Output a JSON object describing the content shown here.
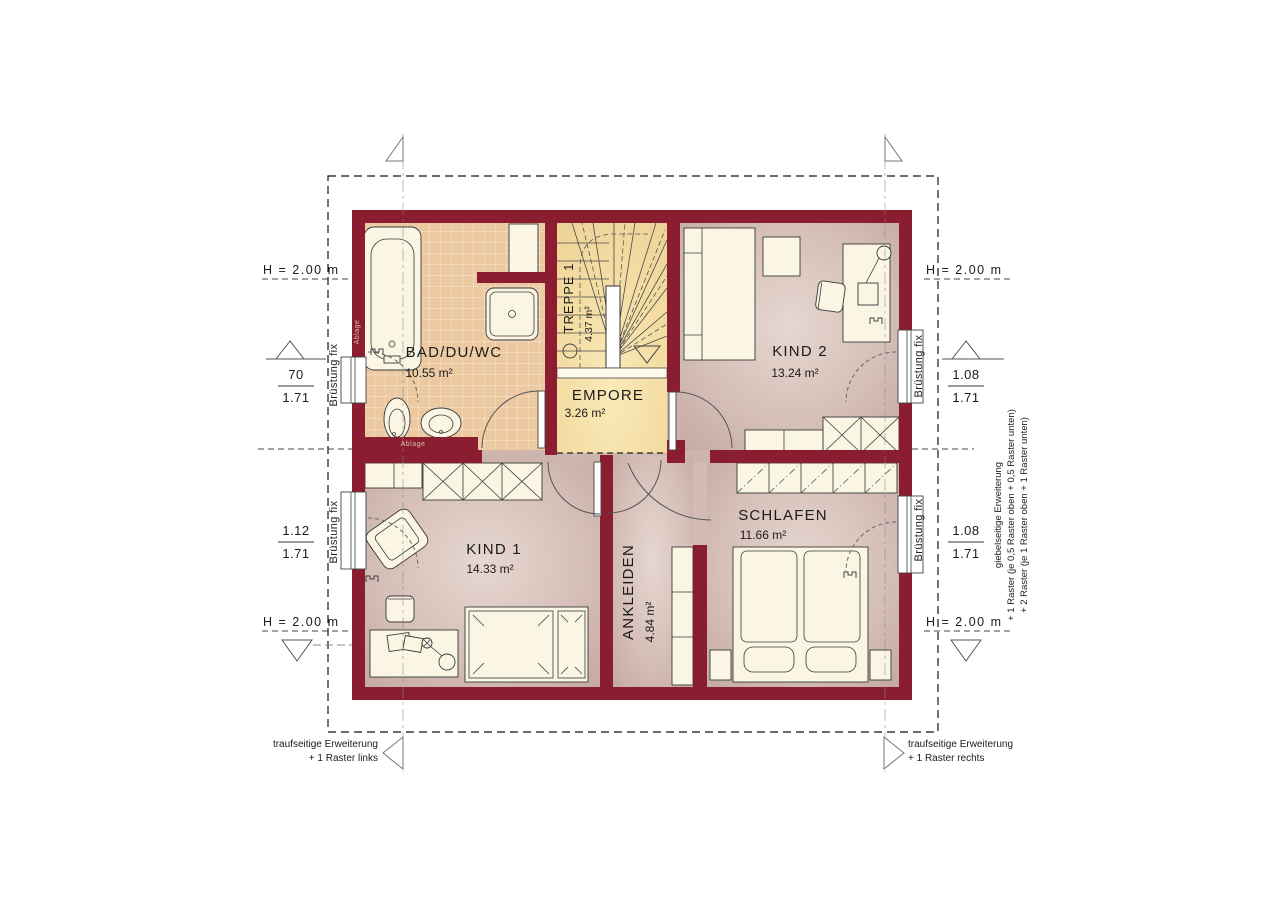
{
  "plan": {
    "rooms": {
      "bad": {
        "name": "BAD/DU/WC",
        "area": "10.55 m²"
      },
      "treppe": {
        "name": "TREPPE 1",
        "area": "4.37 m²"
      },
      "empore": {
        "name": "EMPORE",
        "area": "3.26 m²"
      },
      "kind2": {
        "name": "KIND 2",
        "area": "13.24 m²"
      },
      "kind1": {
        "name": "KIND 1",
        "area": "14.33 m²"
      },
      "ankleiden": {
        "name": "ANKLEIDEN",
        "area": "4.84 m²"
      },
      "schlafen": {
        "name": "SCHLAFEN",
        "area": "11.66 m²"
      }
    },
    "labels": {
      "height_line": "H = 2.00 m",
      "bruestung_fix": "Brüstung fix",
      "ablage": "Ablage"
    },
    "measurements": {
      "left_top": {
        "num": "70",
        "den": "1.71"
      },
      "left_bottom": {
        "num": "1.12",
        "den": "1.71"
      },
      "right_top": {
        "num": "1.08",
        "den": "1.71"
      },
      "right_bottom": {
        "num": "1.08",
        "den": "1.71"
      }
    },
    "extensions": {
      "bottom_left_line1": "traufseitige Erweiterung",
      "bottom_left_line2": "+ 1 Raster links",
      "bottom_right_line1": "traufseitige Erweiterung",
      "bottom_right_line2": "+ 1 Raster rechts",
      "gable_line1": "giebelseitige Erweiterung",
      "gable_line2": "+ 1 Raster (je 0,5 Raster oben + 0,5 Raster unten)",
      "gable_line3": "+ 2 Raster (je 1 Raster oben + 1 Raster unten)"
    },
    "colors": {
      "wall": "#8a1e30",
      "bath_tile": "#ecc9a1",
      "stair_floor": "#f4dca2",
      "room_floor": "#cdb5ad"
    }
  }
}
